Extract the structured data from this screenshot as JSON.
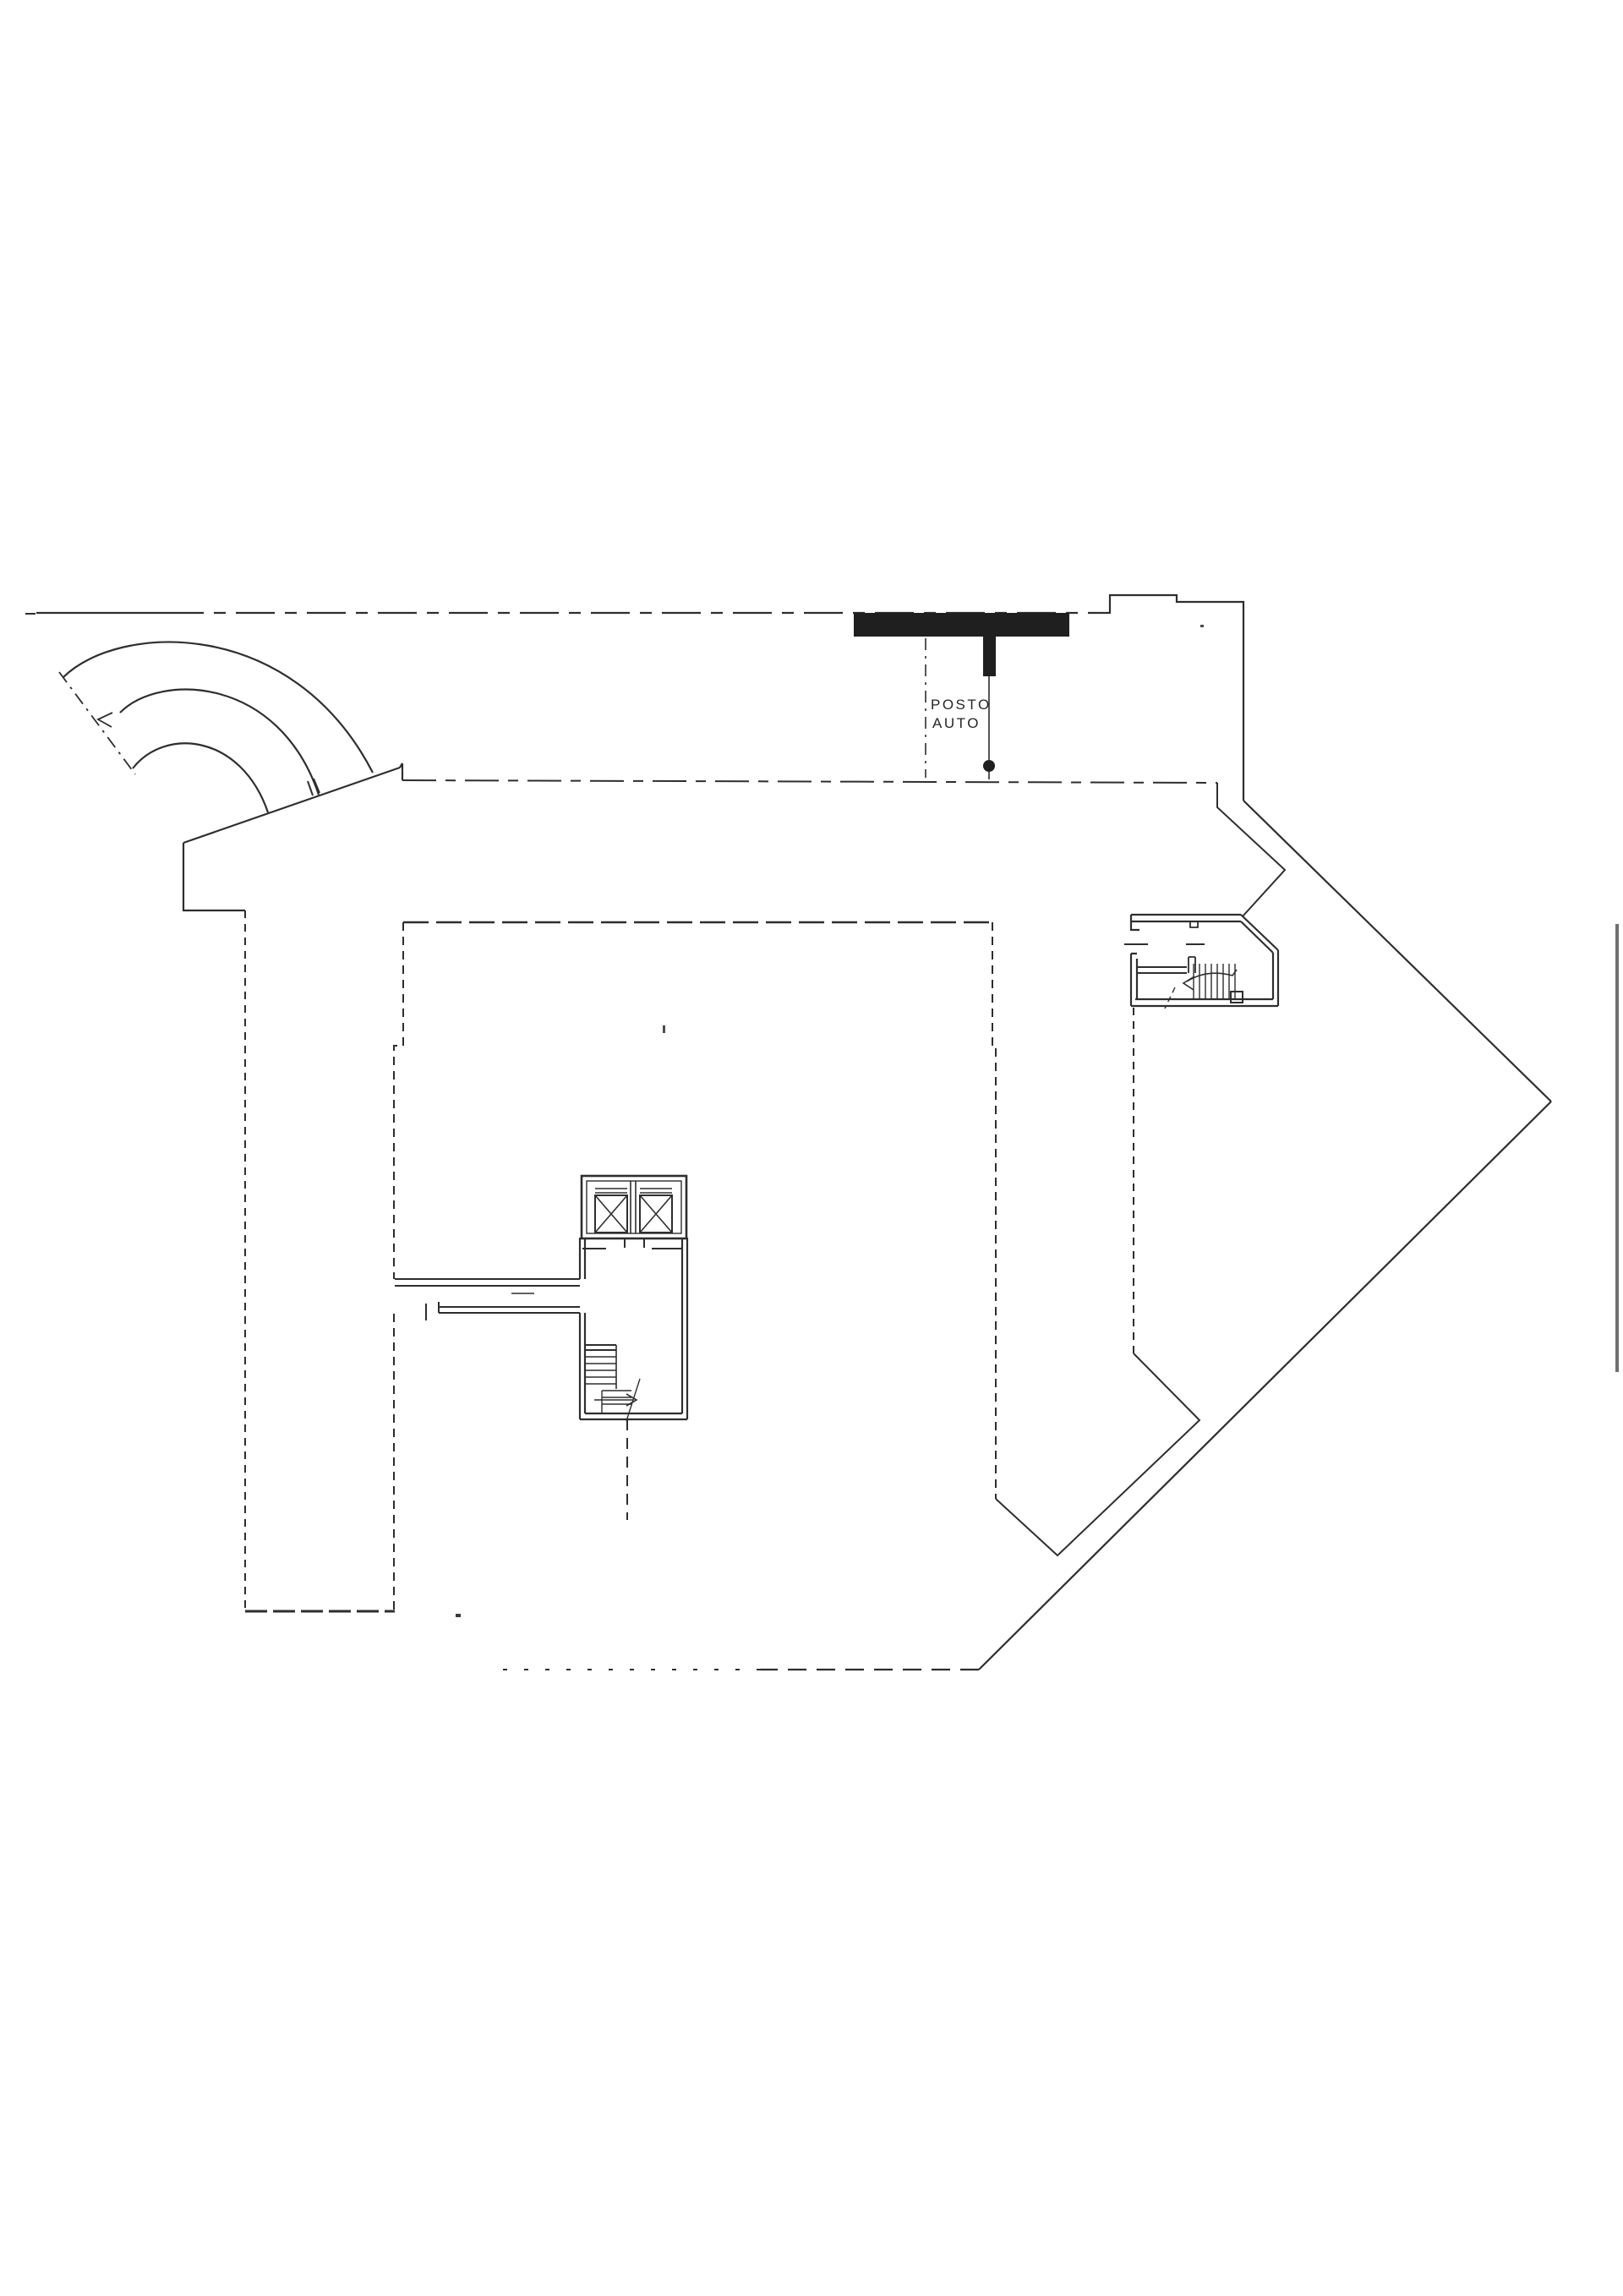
{
  "document": {
    "kind": "scanned architectural floor plan",
    "level": "garage / parking level",
    "language": "Italian"
  },
  "labels": {
    "parking_line1": "POSTO",
    "parking_line2": "AUTO"
  },
  "colors": {
    "paper": "#ffffff",
    "ink": "#2e2e2e",
    "solid_fill": "#1f1f1f",
    "scan_artifact": "#6f6f6f"
  }
}
